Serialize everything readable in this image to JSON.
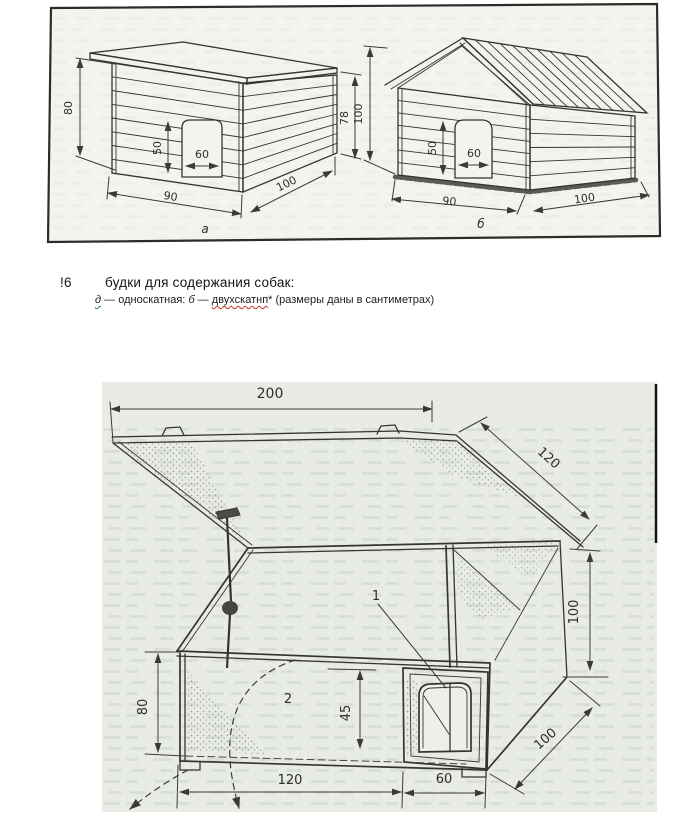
{
  "caption": {
    "figure_number": "!6",
    "title": "будки для содержания собак:",
    "legend_a_letter": "д",
    "legend_a_text": " — односкатная: ",
    "legend_b_letter": "б",
    "legend_b_dash": " — ",
    "legend_b_word": "двухскатнп",
    "legend_tail": "* (размеры даны в сантиметрах)"
  },
  "figure_top": {
    "house_a": {
      "label": "а",
      "height_left": "80",
      "height_right": "78",
      "door_height": "50",
      "door_width": "60",
      "width_front": "90",
      "depth_side": "100"
    },
    "house_b": {
      "label": "б",
      "height_left": "100",
      "door_height": "50",
      "door_width": "60",
      "width_front": "90",
      "depth_side": "100"
    }
  },
  "figure_bottom": {
    "width_top": "200",
    "lid_depth": "120",
    "height_right": "100",
    "height_left": "80",
    "entry_height": "45",
    "width_main": "120",
    "width_entry": "60",
    "depth_right": "100",
    "callout_1": "1",
    "callout_2": "2"
  },
  "colors": {
    "ink": "#35352f",
    "scan_top_bg": "#f3f4ee",
    "scan_bottom_bg": "#e8ece5",
    "spell_red": "#c62f1e",
    "spell_green": "#2e7d32"
  }
}
